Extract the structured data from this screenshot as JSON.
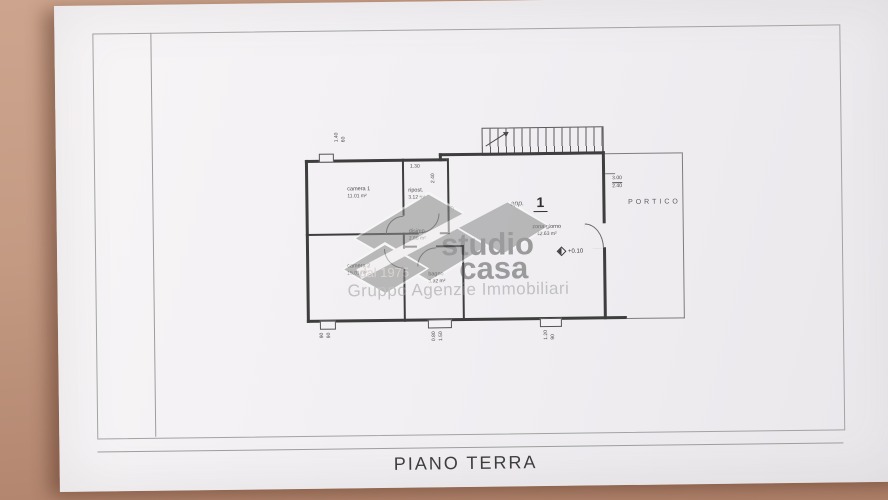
{
  "title": "PIANO TERRA",
  "watermark": {
    "studio": "studio",
    "casa": "casa",
    "registered": "®",
    "since": "dal 1975",
    "tagline": "Gruppo Agenzie Immobiliari"
  },
  "plan": {
    "app_label": "app.",
    "app_number": "1",
    "level": "+0.10",
    "portico_label": "PORTICO",
    "rooms": {
      "camera1": {
        "name": "camera 1",
        "area": "11.01 m²"
      },
      "camera2": {
        "name": "camera 2",
        "area": "15.01 m²"
      },
      "ripost": {
        "name": "ripost.",
        "area": "3.12 m²"
      },
      "disimp": {
        "name": "disimp.",
        "area": "2.86 m²"
      },
      "bagno": {
        "name": "bagno",
        "area": "3.92 m²"
      },
      "zona_giorno": {
        "name": "zona giorno",
        "area": "42.63 m²"
      }
    },
    "dimensions": {
      "corridor_w": "1.30",
      "corridor_d": "2.40",
      "portico_w": "3.00",
      "portico_d": "2.40",
      "win_top": [
        "1.40",
        "60"
      ],
      "win_b1": [
        "90",
        "90"
      ],
      "win_b2": [
        "0.80",
        "1.50"
      ],
      "win_b3": [
        "1.20",
        "90"
      ]
    }
  },
  "colors": {
    "desk": "#c49a83",
    "paper": "#f1eff2",
    "wall": "#3f3e3e",
    "watermark_gray": "#8b8b8b"
  }
}
